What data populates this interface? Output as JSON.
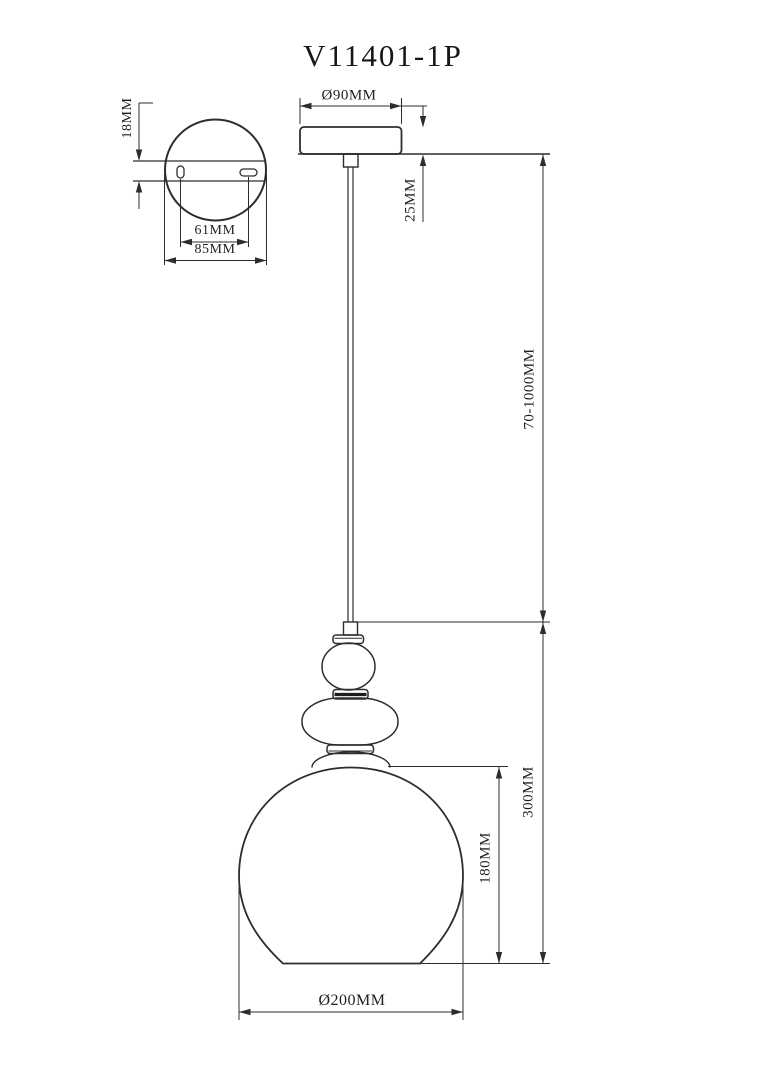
{
  "title": "V11401-1P",
  "views": {
    "plate": {
      "labels": {
        "thickness": "18MM",
        "slot_spacing": "61MM",
        "width": "85MM"
      }
    },
    "pendant": {
      "labels": {
        "canopy_diameter": "Ø90MM",
        "canopy_height": "25MM",
        "suspension_length": "70-1000MM",
        "overall_body_height": "300MM",
        "shade_height": "180MM",
        "shade_diameter": "Ø200MM"
      }
    }
  }
}
